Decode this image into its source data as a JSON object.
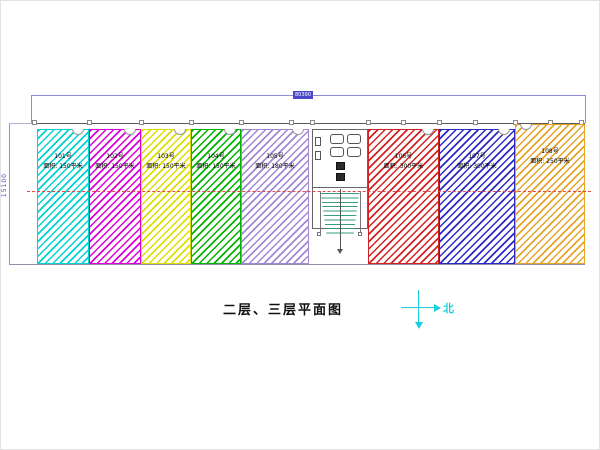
{
  "drawing": {
    "title": "二层、三层平面图",
    "north_label": "北",
    "dimensions": {
      "total_width_label": "80390",
      "total_height_label": "15100"
    },
    "units": [
      {
        "number": "101号",
        "area": "面积: 150平米",
        "color": "#00d4d4",
        "x": 36,
        "w": 52,
        "tall": false,
        "notch": "right"
      },
      {
        "number": "102号",
        "area": "面积: 150平米",
        "color": "#dd00dd",
        "x": 88,
        "w": 52,
        "tall": false,
        "notch": "right"
      },
      {
        "number": "103号",
        "area": "面积: 150平米",
        "color": "#dede00",
        "x": 140,
        "w": 50,
        "tall": false,
        "notch": "right"
      },
      {
        "number": "104号",
        "area": "面积: 150平米",
        "color": "#00b400",
        "x": 190,
        "w": 50,
        "tall": false,
        "notch": "right"
      },
      {
        "number": "105号",
        "area": "面积: 180平米",
        "color": "#a188d6",
        "x": 240,
        "w": 68,
        "tall": false,
        "notch": "right"
      },
      {
        "number": "106号",
        "area": "面积: 300平米",
        "color": "#d42222",
        "x": 367,
        "w": 71,
        "tall": false,
        "notch": "right"
      },
      {
        "number": "107号",
        "area": "面积: 300平米",
        "color": "#2a2ac8",
        "x": 438,
        "w": 76,
        "tall": false,
        "notch": "right"
      },
      {
        "number": "108号",
        "area": "面积: 250平米",
        "color": "#e6a428",
        "x": 514,
        "w": 70,
        "tall": true,
        "notch": "left"
      }
    ]
  }
}
